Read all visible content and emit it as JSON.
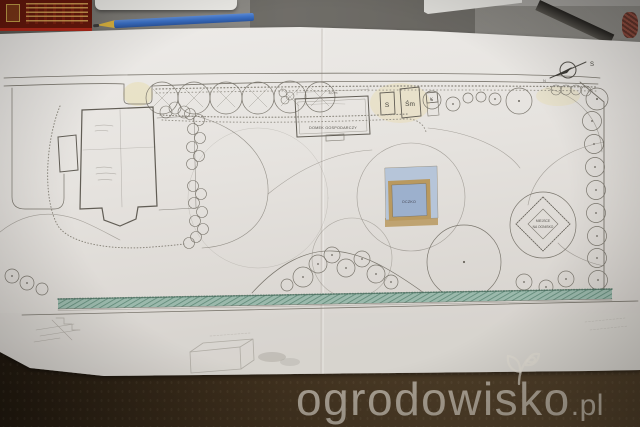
{
  "watermark": {
    "brand": "ogrodowisko",
    "tld": ".pl"
  },
  "plan": {
    "labels": {
      "shed": "DOMEK GOSPODARCZY",
      "shed_dim": "8,0 m",
      "bin_s": "S",
      "bin_sm": "Śm",
      "tap": "K",
      "pond": "OCZKO",
      "fire_1": "MIEJSCE",
      "fire_2": "NA OGNISKO",
      "compass_primary": "S",
      "compass_secondary": "N"
    },
    "colors": {
      "pencil": "#7b776e",
      "pencil_dark": "#55524c",
      "pond_outer": "#b6c5d9",
      "pond_inner": "#9cb0cd",
      "deck_tan": "#b9995f",
      "hedge_fill": "#9bb9ac",
      "hedge_hatch": "#4e7a68",
      "highlight_yellow": "#e8da9c"
    }
  }
}
